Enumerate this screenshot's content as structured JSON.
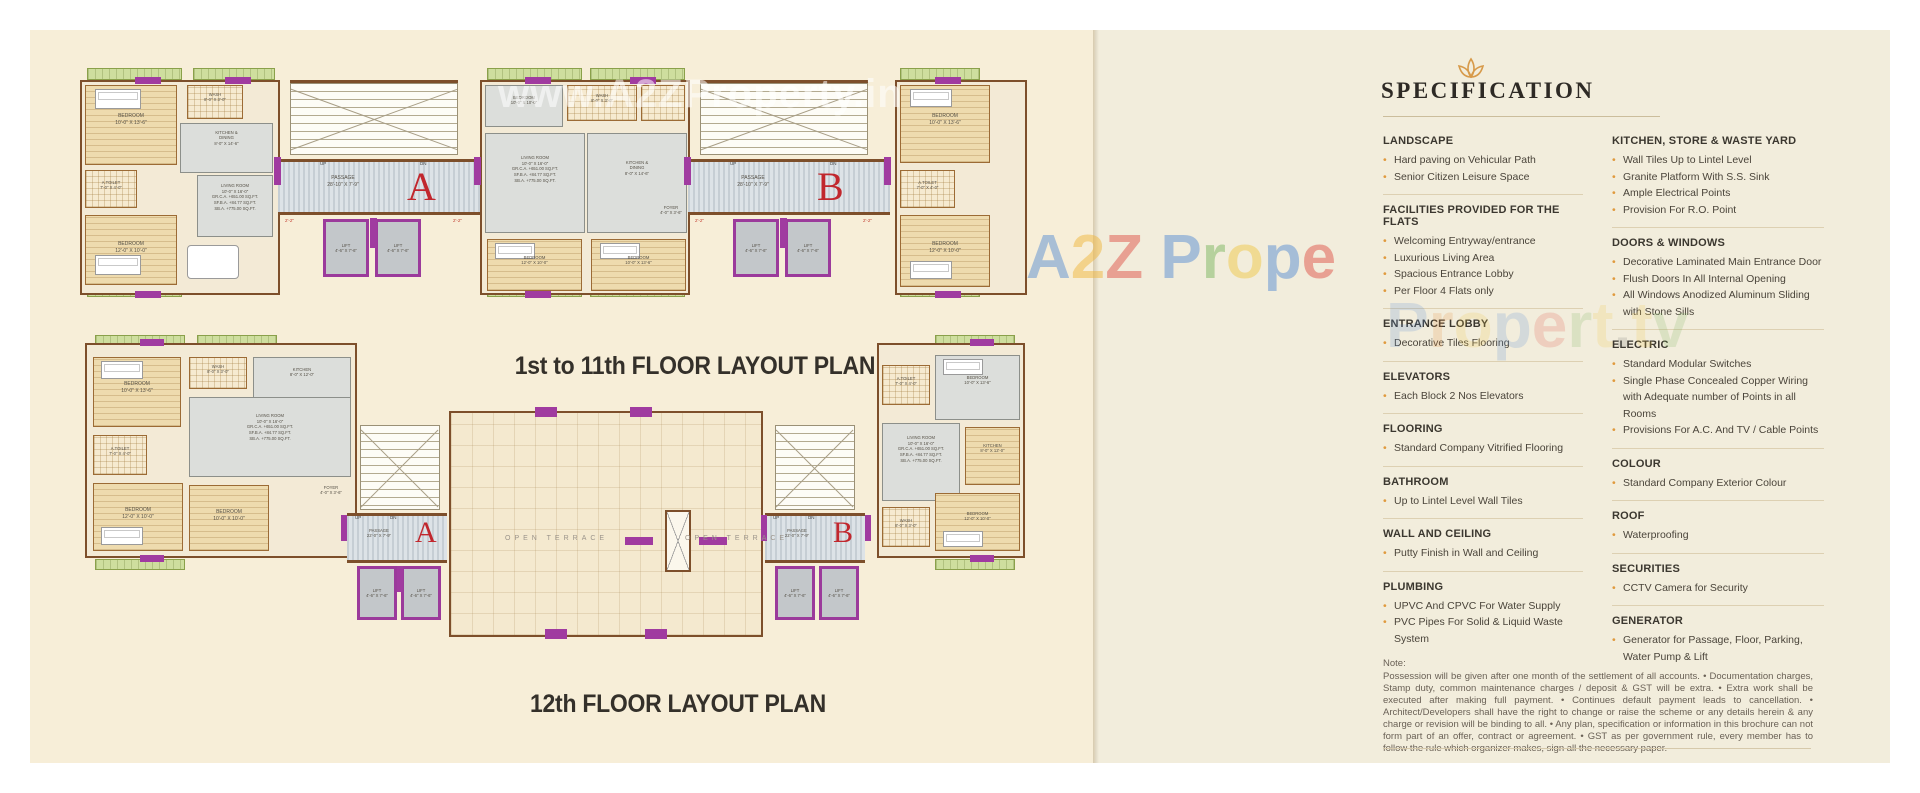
{
  "watermarks": {
    "white": {
      "text": "www.A2ZProperty.in"
    },
    "fold": {
      "text": "A2Z Prope",
      "colors": [
        "#5b8fd4",
        "#f0b73f",
        "#e0564a",
        "#000000",
        "#5b8fd4",
        "#7cb65f",
        "#f0c84a",
        "#5b8fd4",
        "#e0564a"
      ]
    },
    "spec": {
      "text": "Propert.tv",
      "colors": [
        "#5b8fd4",
        "#e8923f",
        "#f0c84a",
        "#5b8fd4",
        "#e0564a",
        "#7cb65f",
        "#f0c84a",
        "#777777",
        "#f0c84a",
        "#7cb65f"
      ]
    }
  },
  "left_page": {
    "lift": "LIFT\n4'-6\" X 7'-6\"",
    "dim": "2'-2\"",
    "rooms": {
      "bedroom_13": "BEDROOM\n10'-0\" X 13'-6\"",
      "bedroom_10": "BEDROOM\n10'-0\" X 10'-0\"",
      "bedroom_12": "BEDROOM\n12'-0\" X 10'-0\"",
      "wash": "WASH\n8'-0\" X 3'-0\"",
      "atoilet": "A.TOILET\n7'-0\" X 4'-0\"",
      "foyer": "FOYER\n4'-0\" X 3'-6\"",
      "kitchen_dining": "KITCHEN &\nDINING\n8'-0\" X 14'-6\"",
      "kitchen": "KITCHEN\n8'-0\" X 12'-0\"",
      "living": "LIVING ROOM\n10'-0\" X 16'-0\"\nGR.C.A. +651.00 SQ.FT.\nSF.B.A. +84.77 SQ.FT.\nSB.A. +775.00 SQ.FT.",
      "arch": "2'-0 WIDE ARCH PRGL"
    },
    "plan1": {
      "title": "1st to 11th FLOOR LAYOUT PLAN",
      "passage": "PASSAGE\n28'-10\" X 7'-9\"",
      "block_a": "A",
      "block_b": "B",
      "up": "UP",
      "dn": "DN"
    },
    "plan2": {
      "title": "12th FLOOR LAYOUT PLAN",
      "passage": "PASSAGE\n22'-0\" X 7'-9\"",
      "open_terrace": "OPEN TERRACE",
      "block_a": "A",
      "block_b": "B",
      "up": "UP",
      "dn": "DN"
    }
  },
  "spec": {
    "title": "SPECIFICATION",
    "left_sections": [
      {
        "heading": "LANDSCAPE",
        "items": [
          "Hard paving on Vehicular Path",
          "Senior Citizen Leisure Space"
        ]
      },
      {
        "heading": "FACILITIES PROVIDED FOR THE FLATS",
        "items": [
          "Welcoming Entryway/entrance",
          "Luxurious Living Area",
          "Spacious Entrance Lobby",
          "Per Floor 4 Flats only"
        ]
      },
      {
        "heading": "ENTRANCE LOBBY",
        "items": [
          "Decorative Tiles Flooring"
        ]
      },
      {
        "heading": "ELEVATORS",
        "items": [
          "Each Block 2 Nos Elevators"
        ]
      },
      {
        "heading": "FLOORING",
        "items": [
          "Standard Company Vitrified Flooring"
        ]
      },
      {
        "heading": "BATHROOM",
        "items": [
          "Up to Lintel Level Wall Tiles"
        ]
      },
      {
        "heading": "WALL AND CEILING",
        "items": [
          "Putty Finish in Wall and Ceiling"
        ]
      },
      {
        "heading": "PLUMBING",
        "items": [
          "UPVC And CPVC For Water Supply",
          "PVC Pipes For Solid & Liquid Waste System"
        ]
      }
    ],
    "right_sections": [
      {
        "heading": "KITCHEN, STORE & WASTE YARD",
        "items": [
          "Wall Tiles Up to Lintel Level",
          "Granite Platform With S.S. Sink",
          "Ample Electrical Points",
          "Provision For R.O. Point"
        ]
      },
      {
        "heading": "DOORS & WINDOWS",
        "items": [
          "Decorative Laminated Main Entrance Door",
          "Flush Doors In All Internal Opening",
          "All Windows Anodized Aluminum Sliding with Stone Sills"
        ]
      },
      {
        "heading": "ELECTRIC",
        "items": [
          "Standard Modular Switches",
          "Single Phase Concealed Copper Wiring with Adequate number of Points in all Rooms",
          "Provisions For A.C. And TV / Cable Points"
        ]
      },
      {
        "heading": "COLOUR",
        "items": [
          "Standard Company Exterior Colour"
        ]
      },
      {
        "heading": "ROOF",
        "items": [
          "Waterproofing"
        ]
      },
      {
        "heading": "SECURITIES",
        "items": [
          "CCTV Camera for Security"
        ]
      },
      {
        "heading": "GENERATOR",
        "items": [
          "Generator for Passage, Floor, Parking, Water Pump & Lift"
        ]
      }
    ],
    "note_heading": "Note:",
    "note_body": "Possession will be given after one month of the settlement of all accounts. • Documentation charges, Stamp duty, common maintenance charges / deposit & GST will be extra. • Extra work shall be executed after making full payment. • Continues default payment leads to cancellation. • Architect/Developers shall have the right to change or raise the scheme or any details herein & any charge or revision will be binding to all. • Any plan, specification or information in this brochure can not form part of an offer, contract or agreement. • GST as per government rule, every member has to follow the rule which organizer makes, sign all the necessary paper."
  }
}
